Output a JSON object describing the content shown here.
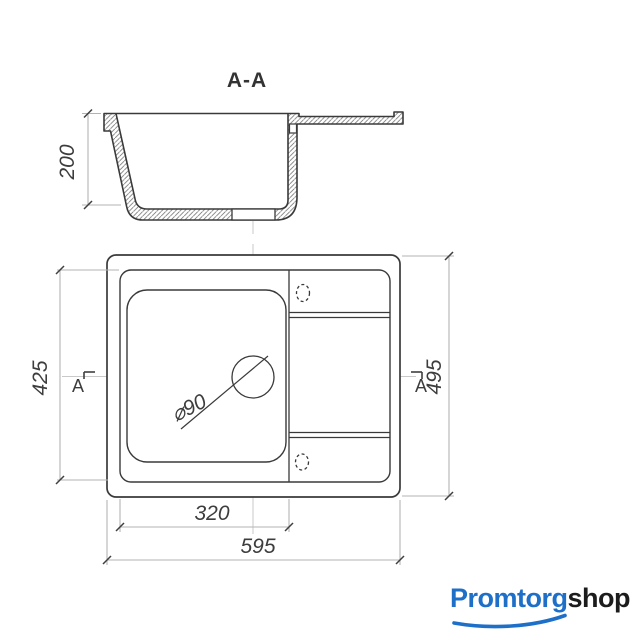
{
  "section_view": {
    "title": "A-A",
    "depth_dim": "200"
  },
  "plan_view": {
    "inner_length_dim": "425",
    "outer_width_dim": "495",
    "bowl_length_dim": "320",
    "outer_length_dim": "595",
    "drain_diameter_label": "⌀90",
    "section_marker_label": "A"
  },
  "logo": {
    "brand_primary": "Promtorg",
    "brand_secondary": "shop"
  },
  "colors": {
    "outline": "#3a3a3a",
    "hatch": "#757575",
    "dimension_line": "#b3b3b3",
    "tick": "#3f3f3f",
    "dimension_text": "#3d3d3d",
    "centerline": "#c9c9c9",
    "logo_blue": "#1e6fc8",
    "logo_dark": "#1c1c1c"
  }
}
